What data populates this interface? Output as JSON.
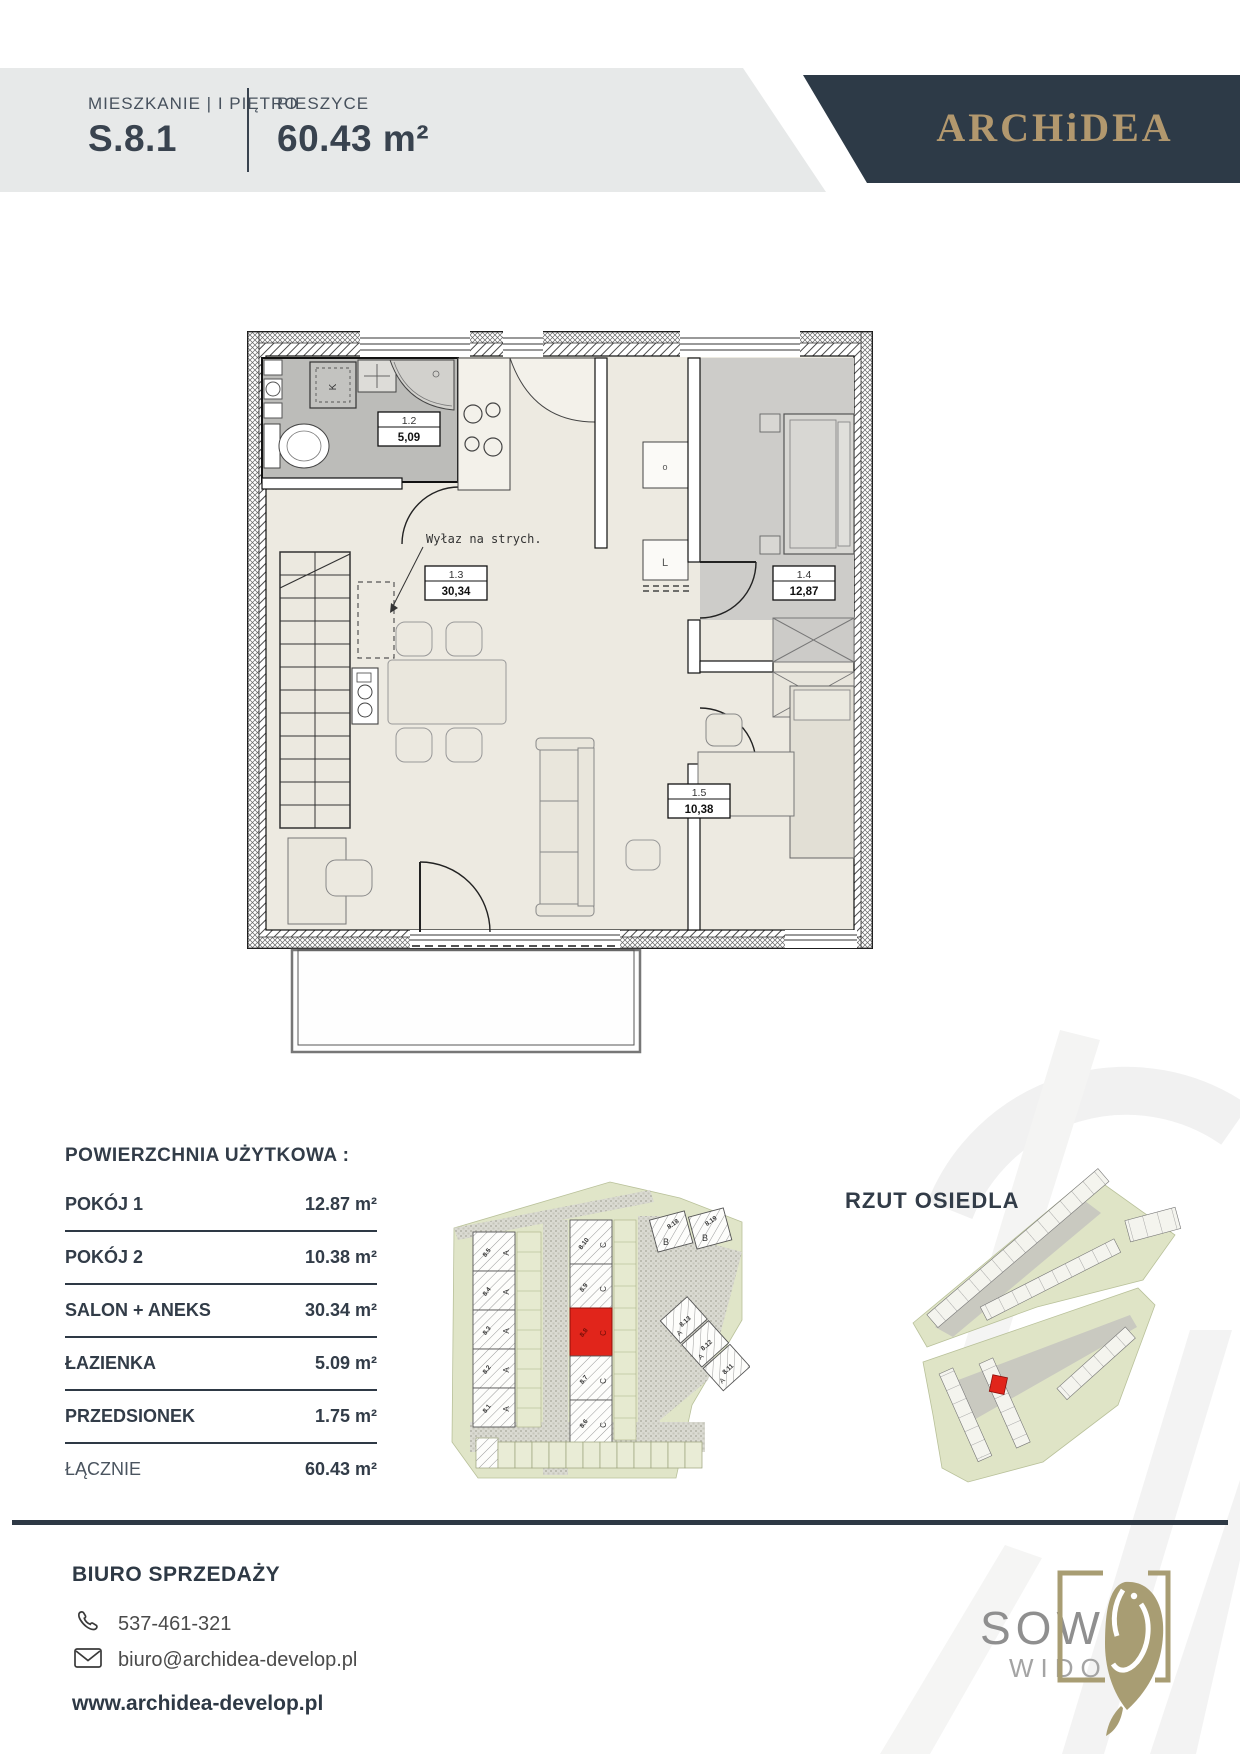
{
  "header": {
    "label": "MIESZKANIE | I PIĘTRO",
    "unit": "S.8.1",
    "city": "PIESZYCE",
    "area": "60.43 m²",
    "brand": "ARCHiDEA"
  },
  "plan": {
    "attic_note": "Wyłaz na strych.",
    "washer": "K",
    "cabinet_small": "o",
    "cabinet_tall": "L",
    "rooms": [
      {
        "no": "1.2",
        "area": "5,09"
      },
      {
        "no": "1.3",
        "area": "30,34"
      },
      {
        "no": "1.4",
        "area": "12,87"
      },
      {
        "no": "1.5",
        "area": "10,38"
      }
    ]
  },
  "table": {
    "title": "POWIERZCHNIA UŻYTKOWA :",
    "rows": [
      {
        "label": "POKÓJ 1",
        "value": "12.87 m²"
      },
      {
        "label": "POKÓJ 2",
        "value": "10.38 m²"
      },
      {
        "label": "SALON + ANEKS",
        "value": "30.34 m²"
      },
      {
        "label": "ŁAZIENKA",
        "value": "5.09 m²"
      },
      {
        "label": "PRZEDSIONEK",
        "value": "1.75 m²"
      },
      {
        "label": "ŁĄCZNIE",
        "value": "60.43 m²"
      }
    ]
  },
  "site": {
    "a": [
      "8.5",
      "8.4",
      "8.3",
      "8.2",
      "8.1"
    ],
    "c": [
      "8.10",
      "8.9",
      "8.8",
      "8.7",
      "8.6"
    ],
    "b": [
      "8.18",
      "8.19"
    ],
    "diag": [
      "8.13",
      "8.12",
      "8.11"
    ],
    "letter_a": "A",
    "letter_b": "B",
    "letter_c": "C"
  },
  "estate": {
    "title": "RZUT OSIEDLA"
  },
  "footer": {
    "office": "BIURO SPRZEDAŻY",
    "phone": "537-461-321",
    "email": "biuro@archidea-develop.pl",
    "website": "www.archidea-develop.pl"
  },
  "logo2": {
    "line1": "SOWI",
    "line2": "WIDOK"
  },
  "colors": {
    "navy": "#2d3a47",
    "gold": "#b2986e",
    "red": "#e1251b",
    "band_gray": "#e7e9e9",
    "site_green": "#dfe4c6"
  }
}
